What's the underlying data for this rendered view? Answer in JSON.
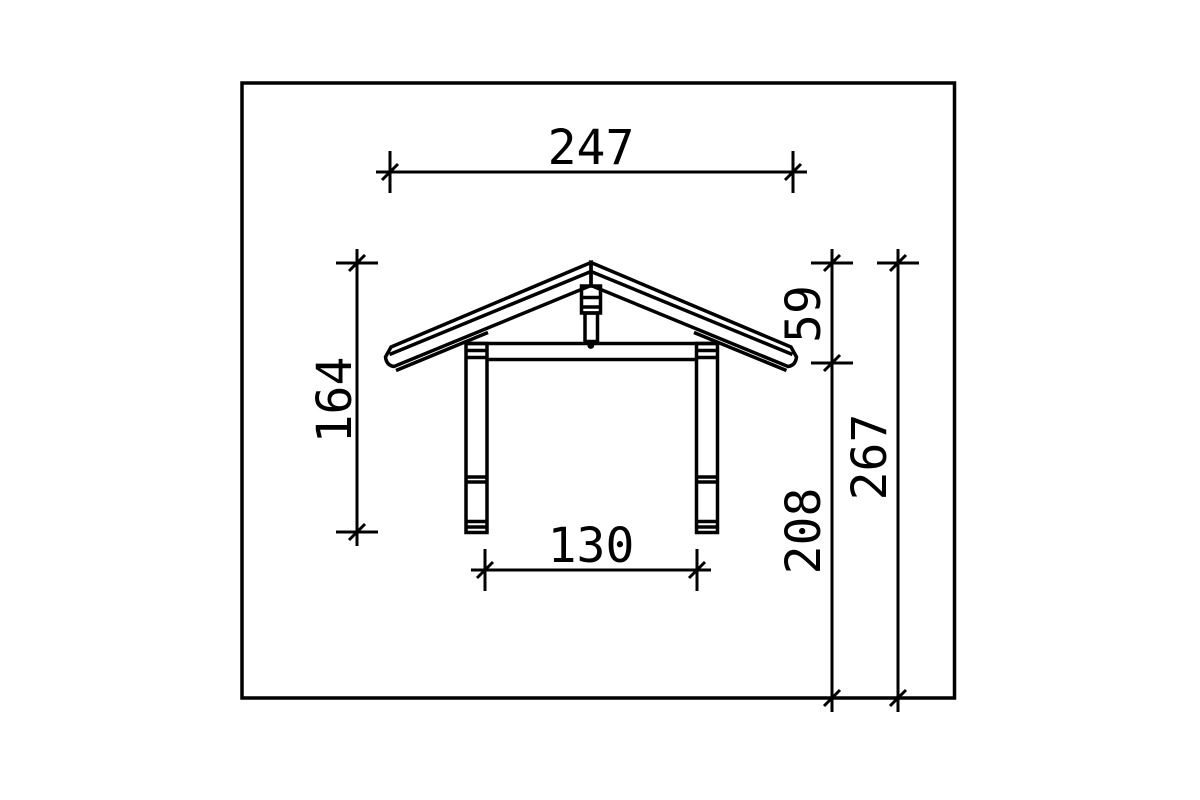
{
  "drawing": {
    "background": "#ffffff",
    "line_color": "#000000",
    "dimensions": {
      "total_width": "247",
      "left_height": "164",
      "roof_height": "59",
      "post_height": "208",
      "total_height": "267",
      "clear_width": "130"
    }
  }
}
